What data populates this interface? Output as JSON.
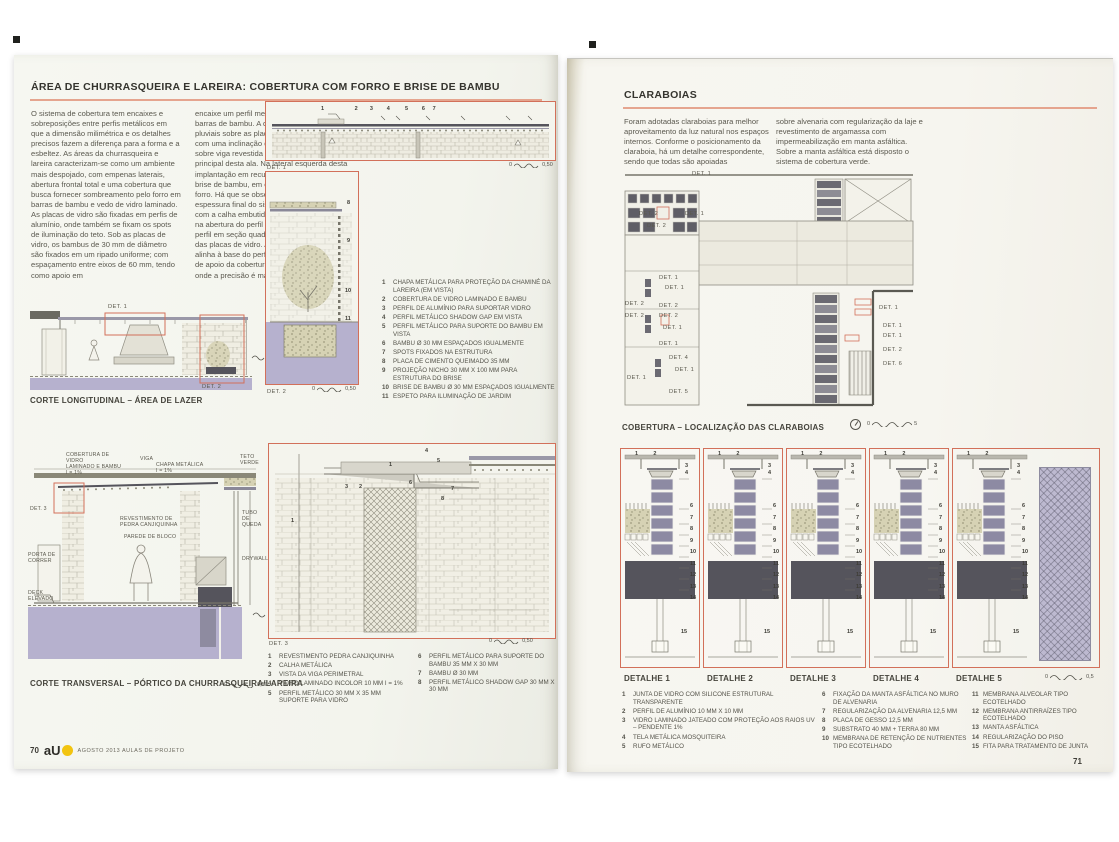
{
  "colors": {
    "accent_red": "#d2705a",
    "lavender": "#b6b1ce",
    "slab_dark": "#55545c",
    "brand_yellow": "#f2c410"
  },
  "page_left": {
    "page_number": "70",
    "brand": "aU",
    "footer_text": "AGOSTO 2013 AULAS DE PROJETO",
    "title": "ÁREA DE CHURRASQUEIRA E LAREIRA: COBERTURA COM FORRO E BRISE DE BAMBU",
    "intro_col1": "O sistema de cobertura tem encaixes e sobreposições entre perfis metálicos em que a dimensão milimétrica e os detalhes precisos fazem a diferença para a forma e a esbeltez. As áreas da churrasqueira e lareira caracterizam-se como um ambiente mais despojado, com empenas laterais, abertura frontal total e uma cobertura que busca fornecer sombreamento pelo forro em barras de bambu e vedo de vidro laminado. As placas de vidro são fixadas em perfis de alumínio, onde também se fixam os spots de iluminação do teto. Sob as placas de vidro, os bambus de 30 mm de diâmetro são fixados em um ripado uniforme; com espaçamento entre eixos de 60 mm, tendo como apoio em",
    "intro_col2": "encaixe um perfil metálico nos extremos das barras de bambu. A drenagem das águas pluviais sobre as placas de vidro são obtidas com uma inclinação de 1%, com calha frontal sobre viga revestida em pedra na fachada principal desta ala. Na lateral esquerda desta implantação em recuo da lateral locou-se o brise de bambu, em continuidade com o forro. Há que se observar a busca da espessura final do sistema de cobertura, com a calha embutida. O bambu é apoiado na abertura do perfil \"C\", que se junta com o perfil em seção quadrada vazada de apoio das placas de vidro. A viga ao fundo se alinha à base do perfil da estrutura metálica de apoio da cobertura de vidro. Um sistema onde a precisão é mais que exigida.",
    "captions": {
      "longitudinal": "CORTE LONGITUDINAL – ÁREA DE LAZER",
      "transversal": "CORTE TRANSVERSAL – PÓRTICO DA CHURRASQUEIRA/LAREIRA"
    },
    "det_labels": {
      "det1": "DET. 1",
      "det2": "DET. 2",
      "det3": "DET. 3"
    },
    "scales": {
      "zero": "0",
      "half": "0,50"
    },
    "legend_top": [
      {
        "n": "1",
        "t": "CHAPA METÁLICA PARA PROTEÇÃO DA CHAMINÉ DA LAREIRA (EM VISTA)"
      },
      {
        "n": "2",
        "t": "COBERTURA DE VIDRO LAMINADO E BAMBU"
      },
      {
        "n": "3",
        "t": "PERFIL DE ALUMÍNIO PARA SUPORTAR VIDRO"
      },
      {
        "n": "4",
        "t": "PERFIL METÁLICO SHADOW GAP EM VISTA"
      },
      {
        "n": "5",
        "t": "PERFIL METÁLICO PARA SUPORTE DO BAMBU EM VISTA"
      },
      {
        "n": "6",
        "t": "BAMBU Ø 30 MM ESPAÇADOS IGUALMENTE"
      },
      {
        "n": "7",
        "t": "SPOTS FIXADOS NA ESTRUTURA"
      },
      {
        "n": "8",
        "t": "PLACA DE CIMENTO QUEIMADO 35 MM"
      },
      {
        "n": "9",
        "t": "PROJEÇÃO NICHO 30 MM X 100 MM PARA ESTRUTURA DO BRISE"
      },
      {
        "n": "10",
        "t": "BRISE DE BAMBU Ø 30 MM ESPAÇADOS IGUALMENTE"
      },
      {
        "n": "11",
        "t": "ESPETO PARA ILUMINAÇÃO DE JARDIM"
      }
    ],
    "legend_bottom": [
      {
        "n": "1",
        "t": "REVESTIMENTO PEDRA CANJIQUINHA"
      },
      {
        "n": "2",
        "t": "CALHA METÁLICA"
      },
      {
        "n": "3",
        "t": "VISTA DA VIGA PERIMETRAL"
      },
      {
        "n": "4",
        "t": "VIDRO LAMINADO INCOLOR 10 MM I = 1%"
      },
      {
        "n": "5",
        "t": "PERFIL METÁLICO 30 MM X 35 MM SUPORTE PARA VIDRO"
      },
      {
        "n": "6",
        "t": "PERFIL METÁLICO PARA SUPORTE DO BAMBU 35 MM X 30 MM"
      },
      {
        "n": "7",
        "t": "BAMBU Ø 30 MM"
      },
      {
        "n": "8",
        "t": "PERFIL METÁLICO SHADOW GAP 30 MM X 30 MM"
      }
    ],
    "drawing_labels": {
      "viga": "VIGA",
      "cobertura": "COBERTURA DE VIDRO\nLAMINADO E BAMBU\nI = 1%",
      "chapa": "CHAPA METÁLICA\nI = 1%",
      "teto_verde": "TETO\nVERDE",
      "revestimento": "REVESTIMENTO DE\nPEDRA CANJIQUINHA",
      "parede": "PAREDE DE BLOCO",
      "tubo": "TUBO DE\nQUEDA",
      "porta": "PORTA DE\nCORRER",
      "drywall": "DRYWALL",
      "deck": "DECK\nELEVADO"
    }
  },
  "page_right": {
    "page_number": "71",
    "title": "CLARABOIAS",
    "intro_col1": "Foram adotadas claraboias para melhor aproveitamento da luz natural nos espaços internos. Conforme o posicionamento da claraboia, há um detalhe correspondente, sendo que todas são apoiadas",
    "intro_col2": "sobre alvenaria com regularização da laje e revestimento de argamassa com impermeabilização em manta asfáltica. Sobre a manta asfáltica está disposto o sistema de cobertura verde.",
    "caption_plan": "COBERTURA – LOCALIZAÇÃO DAS CLARABOIAS",
    "plan_labels": {
      "d1": "DET. 1",
      "d2": "DET. 2",
      "d4": "DET. 4",
      "d5": "DET. 5",
      "d6": "DET. 6"
    },
    "detail_headers": [
      "DETALHE 1",
      "DETALHE 2",
      "DETALHE 3",
      "DETALHE 4",
      "DETALHE 5"
    ],
    "scales": {
      "zero": "0",
      "five": "5",
      "half": "0,5"
    },
    "legend": [
      {
        "n": "1",
        "t": "JUNTA DE VIDRO COM SILICONE ESTRUTURAL TRANSPARENTE"
      },
      {
        "n": "2",
        "t": "PERFIL DE ALUMÍNIO 10 MM X 10 MM"
      },
      {
        "n": "3",
        "t": "VIDRO LAMINADO JATEADO COM PROTEÇÃO AOS RAIOS UV – PENDENTE 1%"
      },
      {
        "n": "4",
        "t": "TELA METÁLICA MOSQUITEIRA"
      },
      {
        "n": "5",
        "t": "RUFO METÁLICO"
      },
      {
        "n": "6",
        "t": "FIXAÇÃO DA MANTA ASFÁLTICA NO MURO DE ALVENARIA"
      },
      {
        "n": "7",
        "t": "REGULARIZAÇÃO DA ALVENARIA 12,5 MM"
      },
      {
        "n": "8",
        "t": "PLACA DE GESSO 12,5 MM"
      },
      {
        "n": "9",
        "t": "SUBSTRATO 40 MM + TERRA 80 MM"
      },
      {
        "n": "10",
        "t": "MEMBRANA DE RETENÇÃO DE NUTRIENTES TIPO ECOTELHADO"
      },
      {
        "n": "11",
        "t": "MEMBRANA ALVEOLAR TIPO ECOTELHADO"
      },
      {
        "n": "12",
        "t": "MEMBRANA ANTIRRAÍZES TIPO ECOTELHADO"
      },
      {
        "n": "13",
        "t": "MANTA ASFÁLTICA"
      },
      {
        "n": "14",
        "t": "REGULARIZAÇÃO DO PISO"
      },
      {
        "n": "15",
        "t": "FITA PARA TRATAMENTO DE JUNTA"
      }
    ]
  },
  "callouts": {
    "row_det1": "1                    2        3         4          5         6     7",
    "det2": [
      "8",
      "9",
      "10",
      "11"
    ],
    "det3": [
      "1",
      "2",
      "3",
      "4",
      "5",
      "6",
      "7",
      "8"
    ],
    "top_a": "1          2",
    "top_b": "3\n4",
    "col": "6\n7\n8\n9\n10\n11\n12\n13\n14",
    "c15": "15"
  }
}
